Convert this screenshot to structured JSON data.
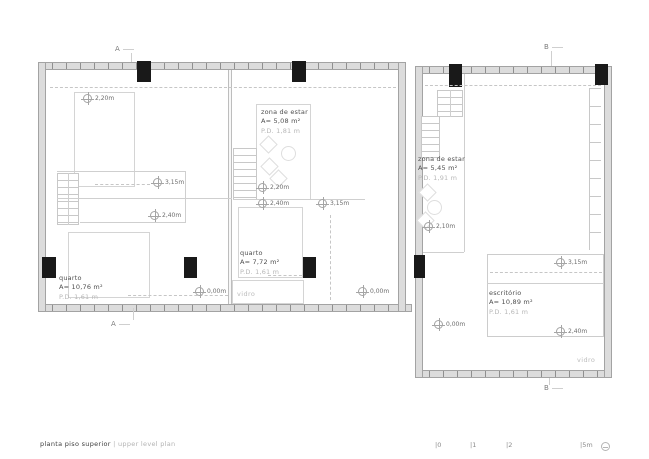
{
  "plan": {
    "rooms": [
      {
        "name": "quarto",
        "area": "A= 10,76 m²",
        "pd": "P.D. 1,61 m"
      },
      {
        "name": "zona de estar",
        "area": "A= 5,08 m²",
        "pd": "P.D. 1,81 m"
      },
      {
        "name": "quarto",
        "area": "A= 7,72 m²",
        "pd": "P.D. 1,61 m"
      },
      {
        "name": "zona de estar",
        "area": "A= 5,45 m²",
        "pd": "P.D. 1,91 m"
      },
      {
        "name": "escritório",
        "area": "A= 10,89 m²",
        "pd": "P.D. 1,61 m"
      }
    ],
    "glass": [
      "vidro",
      "vidro"
    ],
    "levels": [
      "2,20m",
      "3,15m",
      "2,40m",
      "0,00m",
      "2,20m",
      "2,40m",
      "3,15m",
      "0,00m",
      "2,10m",
      "3,15m",
      "0,00m",
      "2,40m"
    ],
    "sections": [
      "A",
      "A",
      "B",
      "B"
    ]
  },
  "footer": {
    "title_pt": "planta piso superior",
    "divider": "|",
    "title_en": "upper level plan"
  },
  "scale": {
    "ticks": [
      "|0",
      "|1",
      "|2",
      "|5m"
    ]
  },
  "colors": {
    "wall": "#dcdcdc",
    "wall_edge": "#a3a3a3",
    "column": "#191919",
    "linework": "#cfcfcf",
    "text": "#4f4f4f",
    "text_light": "#b7b7b7"
  }
}
